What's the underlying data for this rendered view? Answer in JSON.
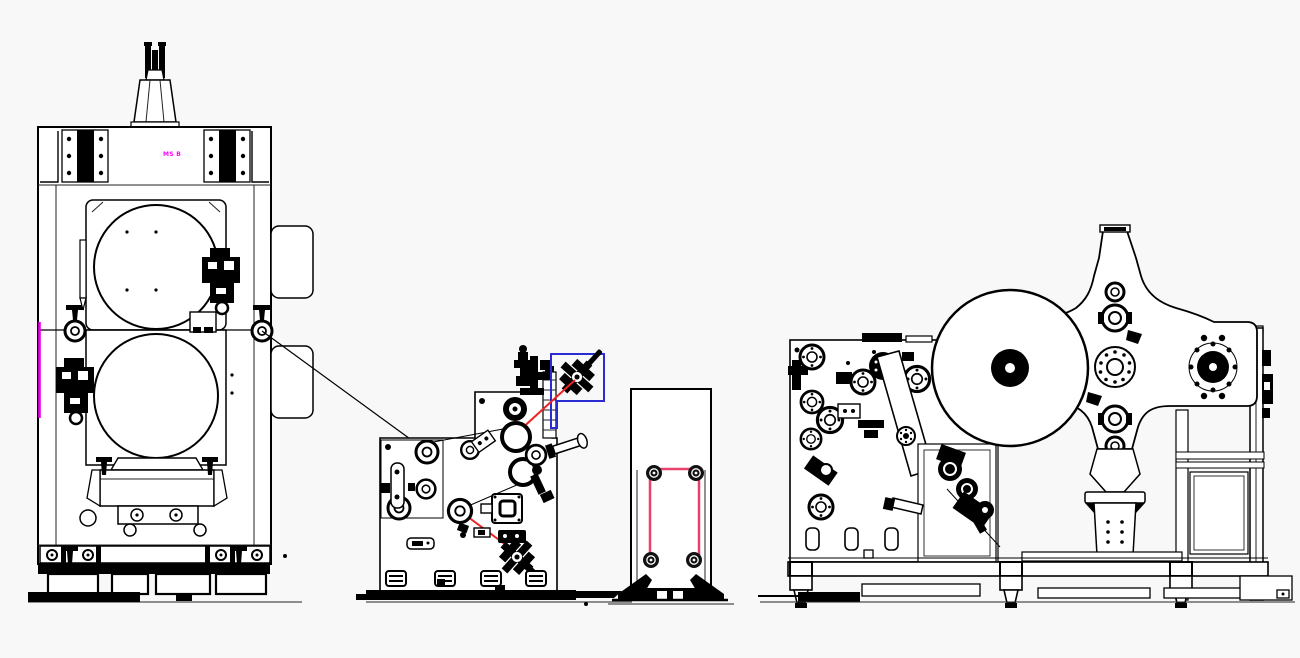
{
  "canvas": {
    "width": 1300,
    "height": 658,
    "background": "#f8f8f8",
    "ink": "#000000"
  },
  "annotations": {
    "press_label": {
      "text": "MS B",
      "color": "#ff00ff"
    },
    "highlight_box": {
      "color": "#2b2bd4"
    },
    "web_marks": {
      "red": "#ee2222",
      "pink": "#e8416b"
    },
    "edge_mark": {
      "color": "#e800e8"
    }
  },
  "components": [
    {
      "id": "press-machine"
    },
    {
      "id": "coater-unit"
    },
    {
      "id": "web-stand"
    },
    {
      "id": "turret-winder"
    }
  ]
}
